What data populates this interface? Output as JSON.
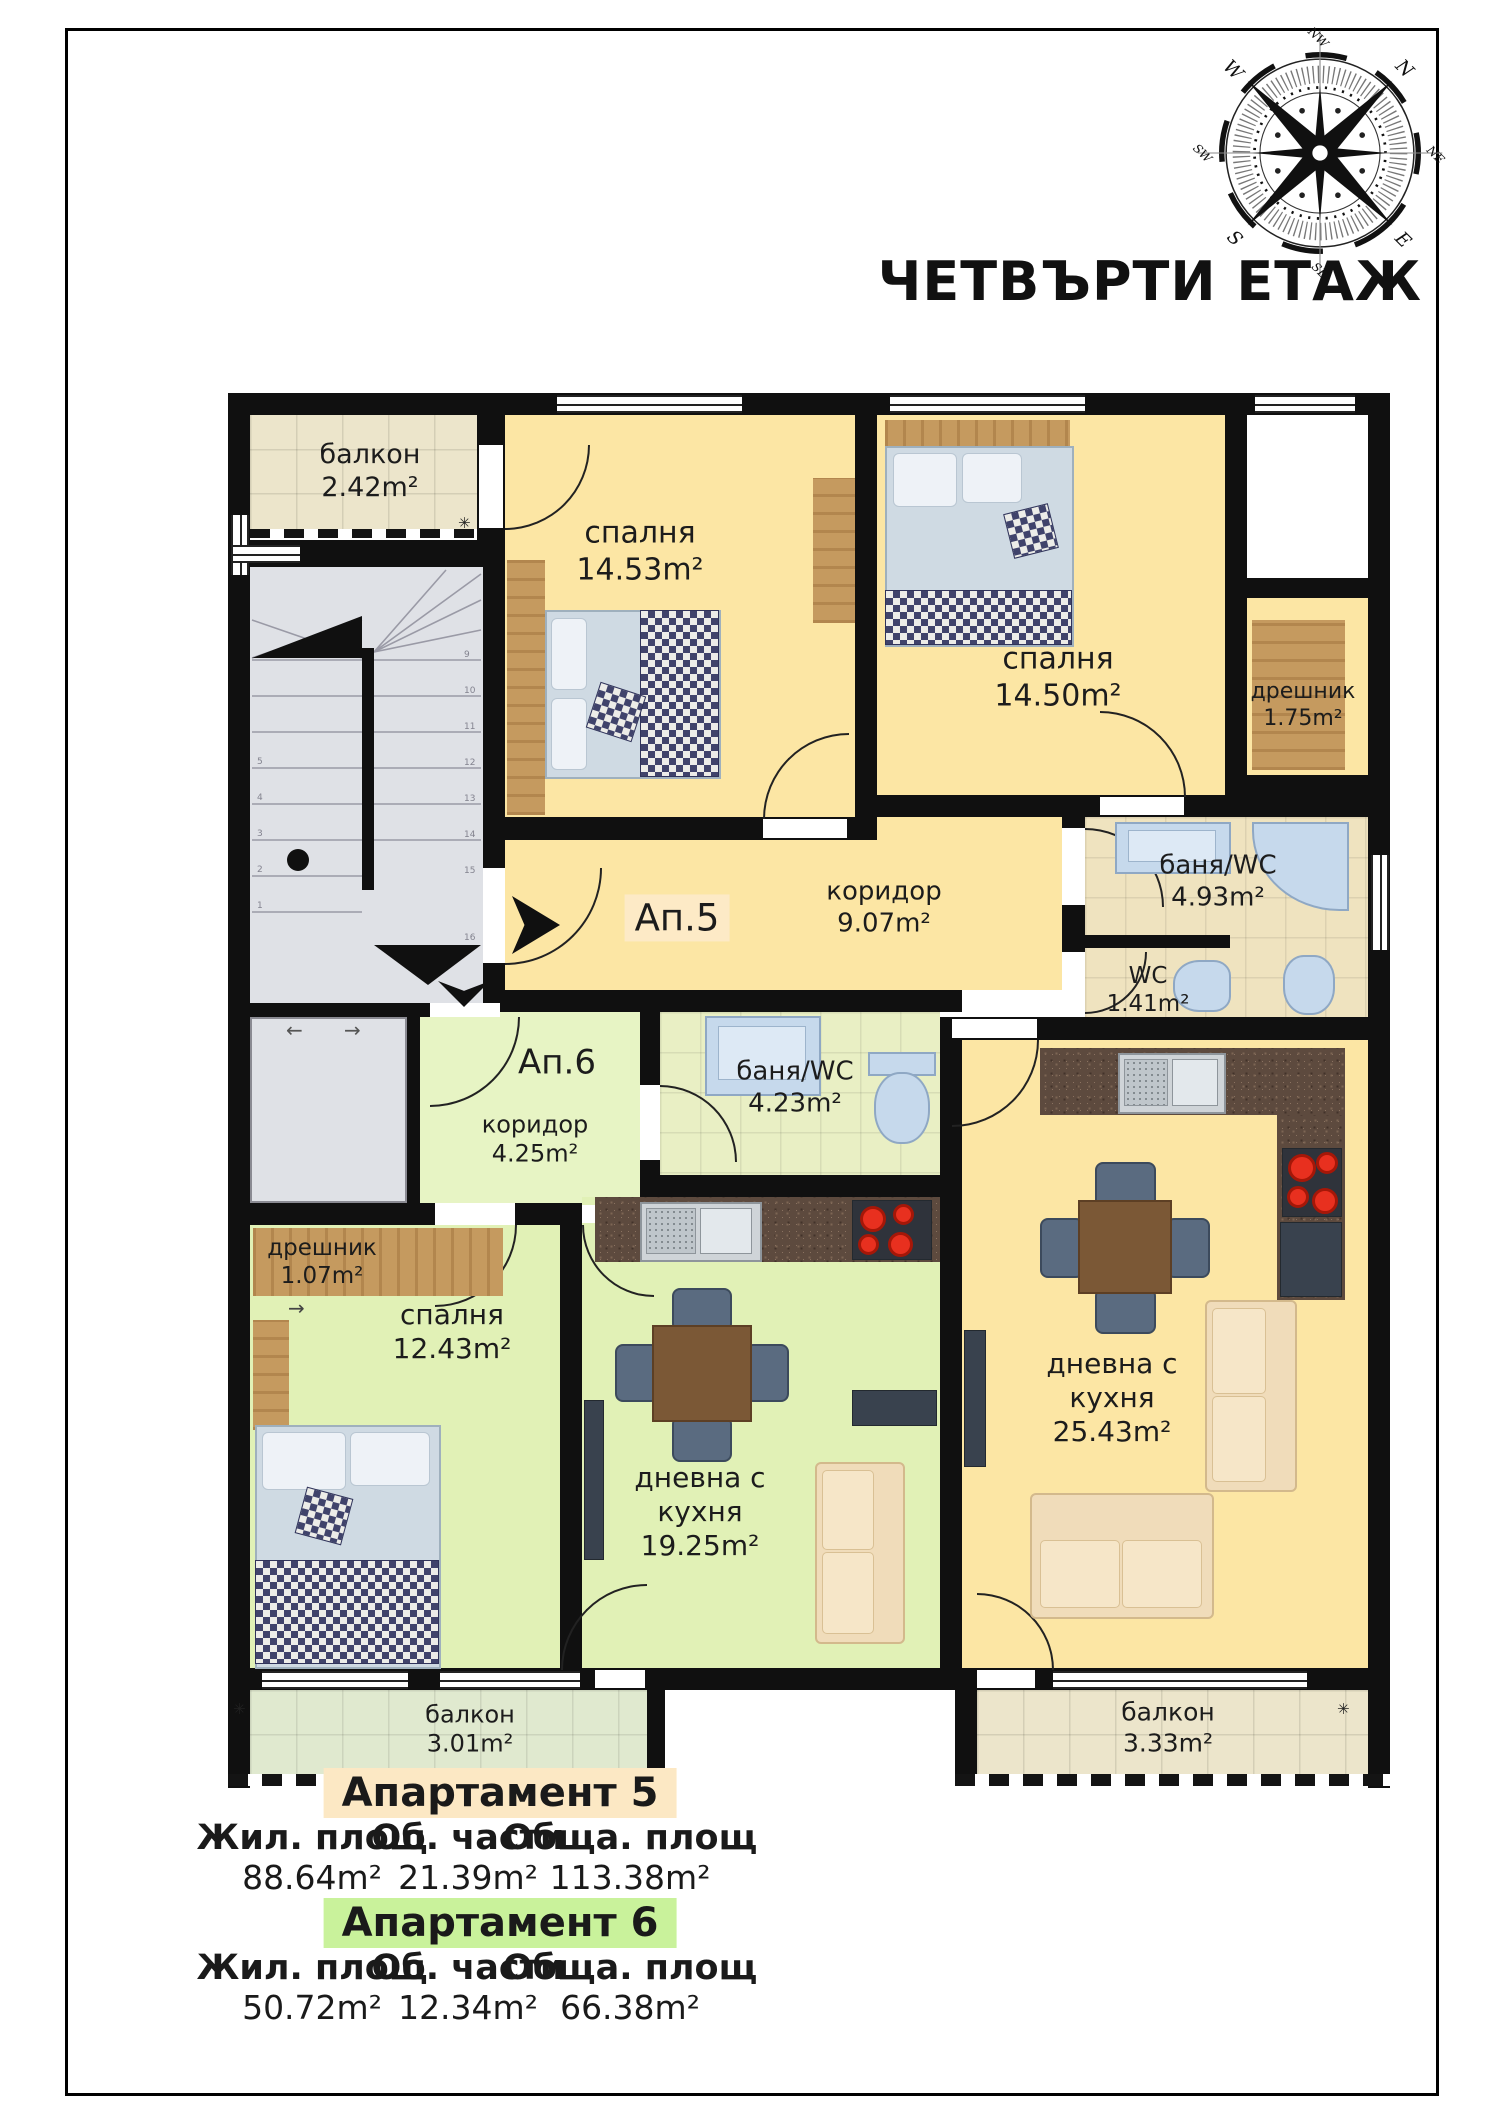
{
  "title": "ЧЕТВЪРТИ ЕТАЖ",
  "compass": {
    "n": "N",
    "ne": "NE",
    "e": "E",
    "se": "SE",
    "s": "S",
    "sw": "SW",
    "w": "W",
    "nw": "NW"
  },
  "apartments": {
    "ap5": {
      "label": "Ап.5"
    },
    "ap6": {
      "label": "Ап.6"
    }
  },
  "rooms": {
    "balcony_top": {
      "name": "балкон",
      "area": "2.42m²"
    },
    "bedroom_a5_1": {
      "name": "спалня",
      "area": "14.53m²"
    },
    "bedroom_a5_2": {
      "name": "спалня",
      "area": "14.50m²"
    },
    "closet_a5": {
      "name": "дрешник",
      "area": "1.75m²"
    },
    "bath_a5": {
      "name": "баня/WC",
      "area": "4.93m²"
    },
    "wc_a5": {
      "name": "WC",
      "area": "1.41m²"
    },
    "corridor_a5": {
      "name": "коридор",
      "area": "9.07m²"
    },
    "corridor_a6": {
      "name": "коридор",
      "area": "4.25m²"
    },
    "bath_a6": {
      "name": "баня/WC",
      "area": "4.23m²"
    },
    "closet_a6": {
      "name": "дрешник",
      "area": "1.07m²"
    },
    "bedroom_a6": {
      "name": "спалня",
      "area": "12.43m²"
    },
    "living_a6": {
      "name": "дневна с",
      "name2": "кухня",
      "area": "19.25m²"
    },
    "living_a5": {
      "name": "дневна с",
      "name2": "кухня",
      "area": "25.43m²"
    },
    "balcony_a6": {
      "name": "балкон",
      "area": "3.01m²"
    },
    "balcony_a5": {
      "name": "балкон",
      "area": "3.33m²"
    }
  },
  "legend": {
    "columns": [
      "Жил. площ",
      "Об. части",
      "Обща. площ"
    ],
    "apartments": [
      {
        "name": "Апартамент 5",
        "values": [
          "88.64m²",
          "21.39m²",
          "113.38m²"
        ]
      },
      {
        "name": "Апартамент 6",
        "values": [
          "50.72m²",
          "12.34m²",
          "66.38m²"
        ]
      }
    ]
  },
  "stairs": {
    "numbers": [
      "1",
      "2",
      "3",
      "4",
      "5",
      "6",
      "7",
      "8",
      "9",
      "10",
      "11",
      "12",
      "13",
      "14",
      "15",
      "16"
    ]
  },
  "symbols": {
    "vent": "✳",
    "arrow_left": "←",
    "arrow_right": "→",
    "arrow_down": "↓"
  }
}
